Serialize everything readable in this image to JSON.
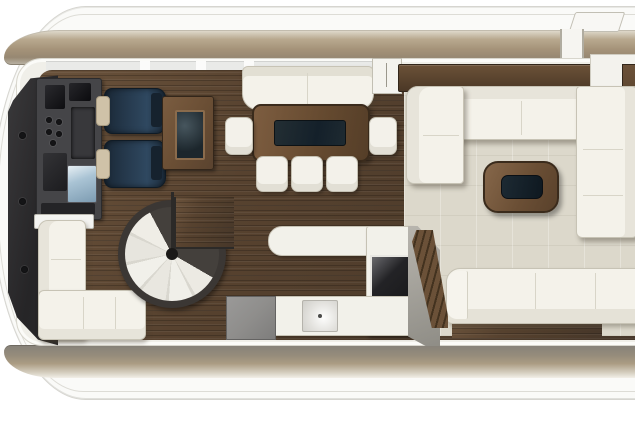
{
  "meta": {
    "title": "Motor yacht main-deck floor plan",
    "view": "top-down",
    "visible_text": []
  },
  "colors": {
    "hull_white": "#fafaf8",
    "hull_line": "#d6d5d0",
    "deck_tan": "#a59379",
    "deck_gray": "#968c7b",
    "cabin_wall": "#f0efe9",
    "floor_walnut": "#57422f",
    "floor_walnut_dark": "#47372a",
    "carpet_beige": "#dcd8cb",
    "upholstery_cream": "#f4f2ea",
    "upholstery_shadow": "#c7c3b5",
    "seat_navy": "#24374a",
    "console_charcoal": "#454548",
    "bulkhead_black": "#29282a",
    "wood_furniture": "#6b4f35",
    "wood_dark_trim": "#3a2b1c",
    "inlay_dark": "#14202a",
    "screen_blue": "#a9c3d4",
    "appliance_gray": "#8f8e8c",
    "cooktop_black": "#1a1a1c",
    "stair_tread_white": "#eceae3"
  },
  "furniture": [
    {
      "name": "helm-console",
      "area": "helm-station",
      "finish": "charcoal"
    },
    {
      "name": "helm-seat-forward",
      "area": "helm-station",
      "finish": "navy"
    },
    {
      "name": "helm-seat-aft",
      "area": "helm-station",
      "finish": "navy"
    },
    {
      "name": "helm-side-cabinet",
      "area": "helm-station",
      "finish": "walnut"
    },
    {
      "name": "dining-bench",
      "area": "dining",
      "finish": "cream"
    },
    {
      "name": "dining-table",
      "area": "dining",
      "finish": "walnut"
    },
    {
      "name": "dining-chairs",
      "area": "dining",
      "count": 5,
      "finish": "cream"
    },
    {
      "name": "spiral-staircase",
      "area": "companionway"
    },
    {
      "name": "galley-counter",
      "area": "galley",
      "finish": "white"
    },
    {
      "name": "galley-sink",
      "area": "galley"
    },
    {
      "name": "galley-cooktop",
      "area": "galley"
    },
    {
      "name": "galley-appliance",
      "area": "galley",
      "finish": "gray"
    },
    {
      "name": "steps-down",
      "area": "companionway",
      "finish": "walnut"
    },
    {
      "name": "saloon-u-sofa",
      "area": "saloon",
      "finish": "cream"
    },
    {
      "name": "saloon-coffee-table",
      "area": "saloon",
      "finish": "walnut"
    },
    {
      "name": "saloon-aft-sofa",
      "area": "saloon",
      "finish": "cream"
    },
    {
      "name": "port-l-sofa",
      "area": "lounge",
      "finish": "cream"
    },
    {
      "name": "sideboard",
      "area": "saloon",
      "finish": "walnut"
    }
  ]
}
